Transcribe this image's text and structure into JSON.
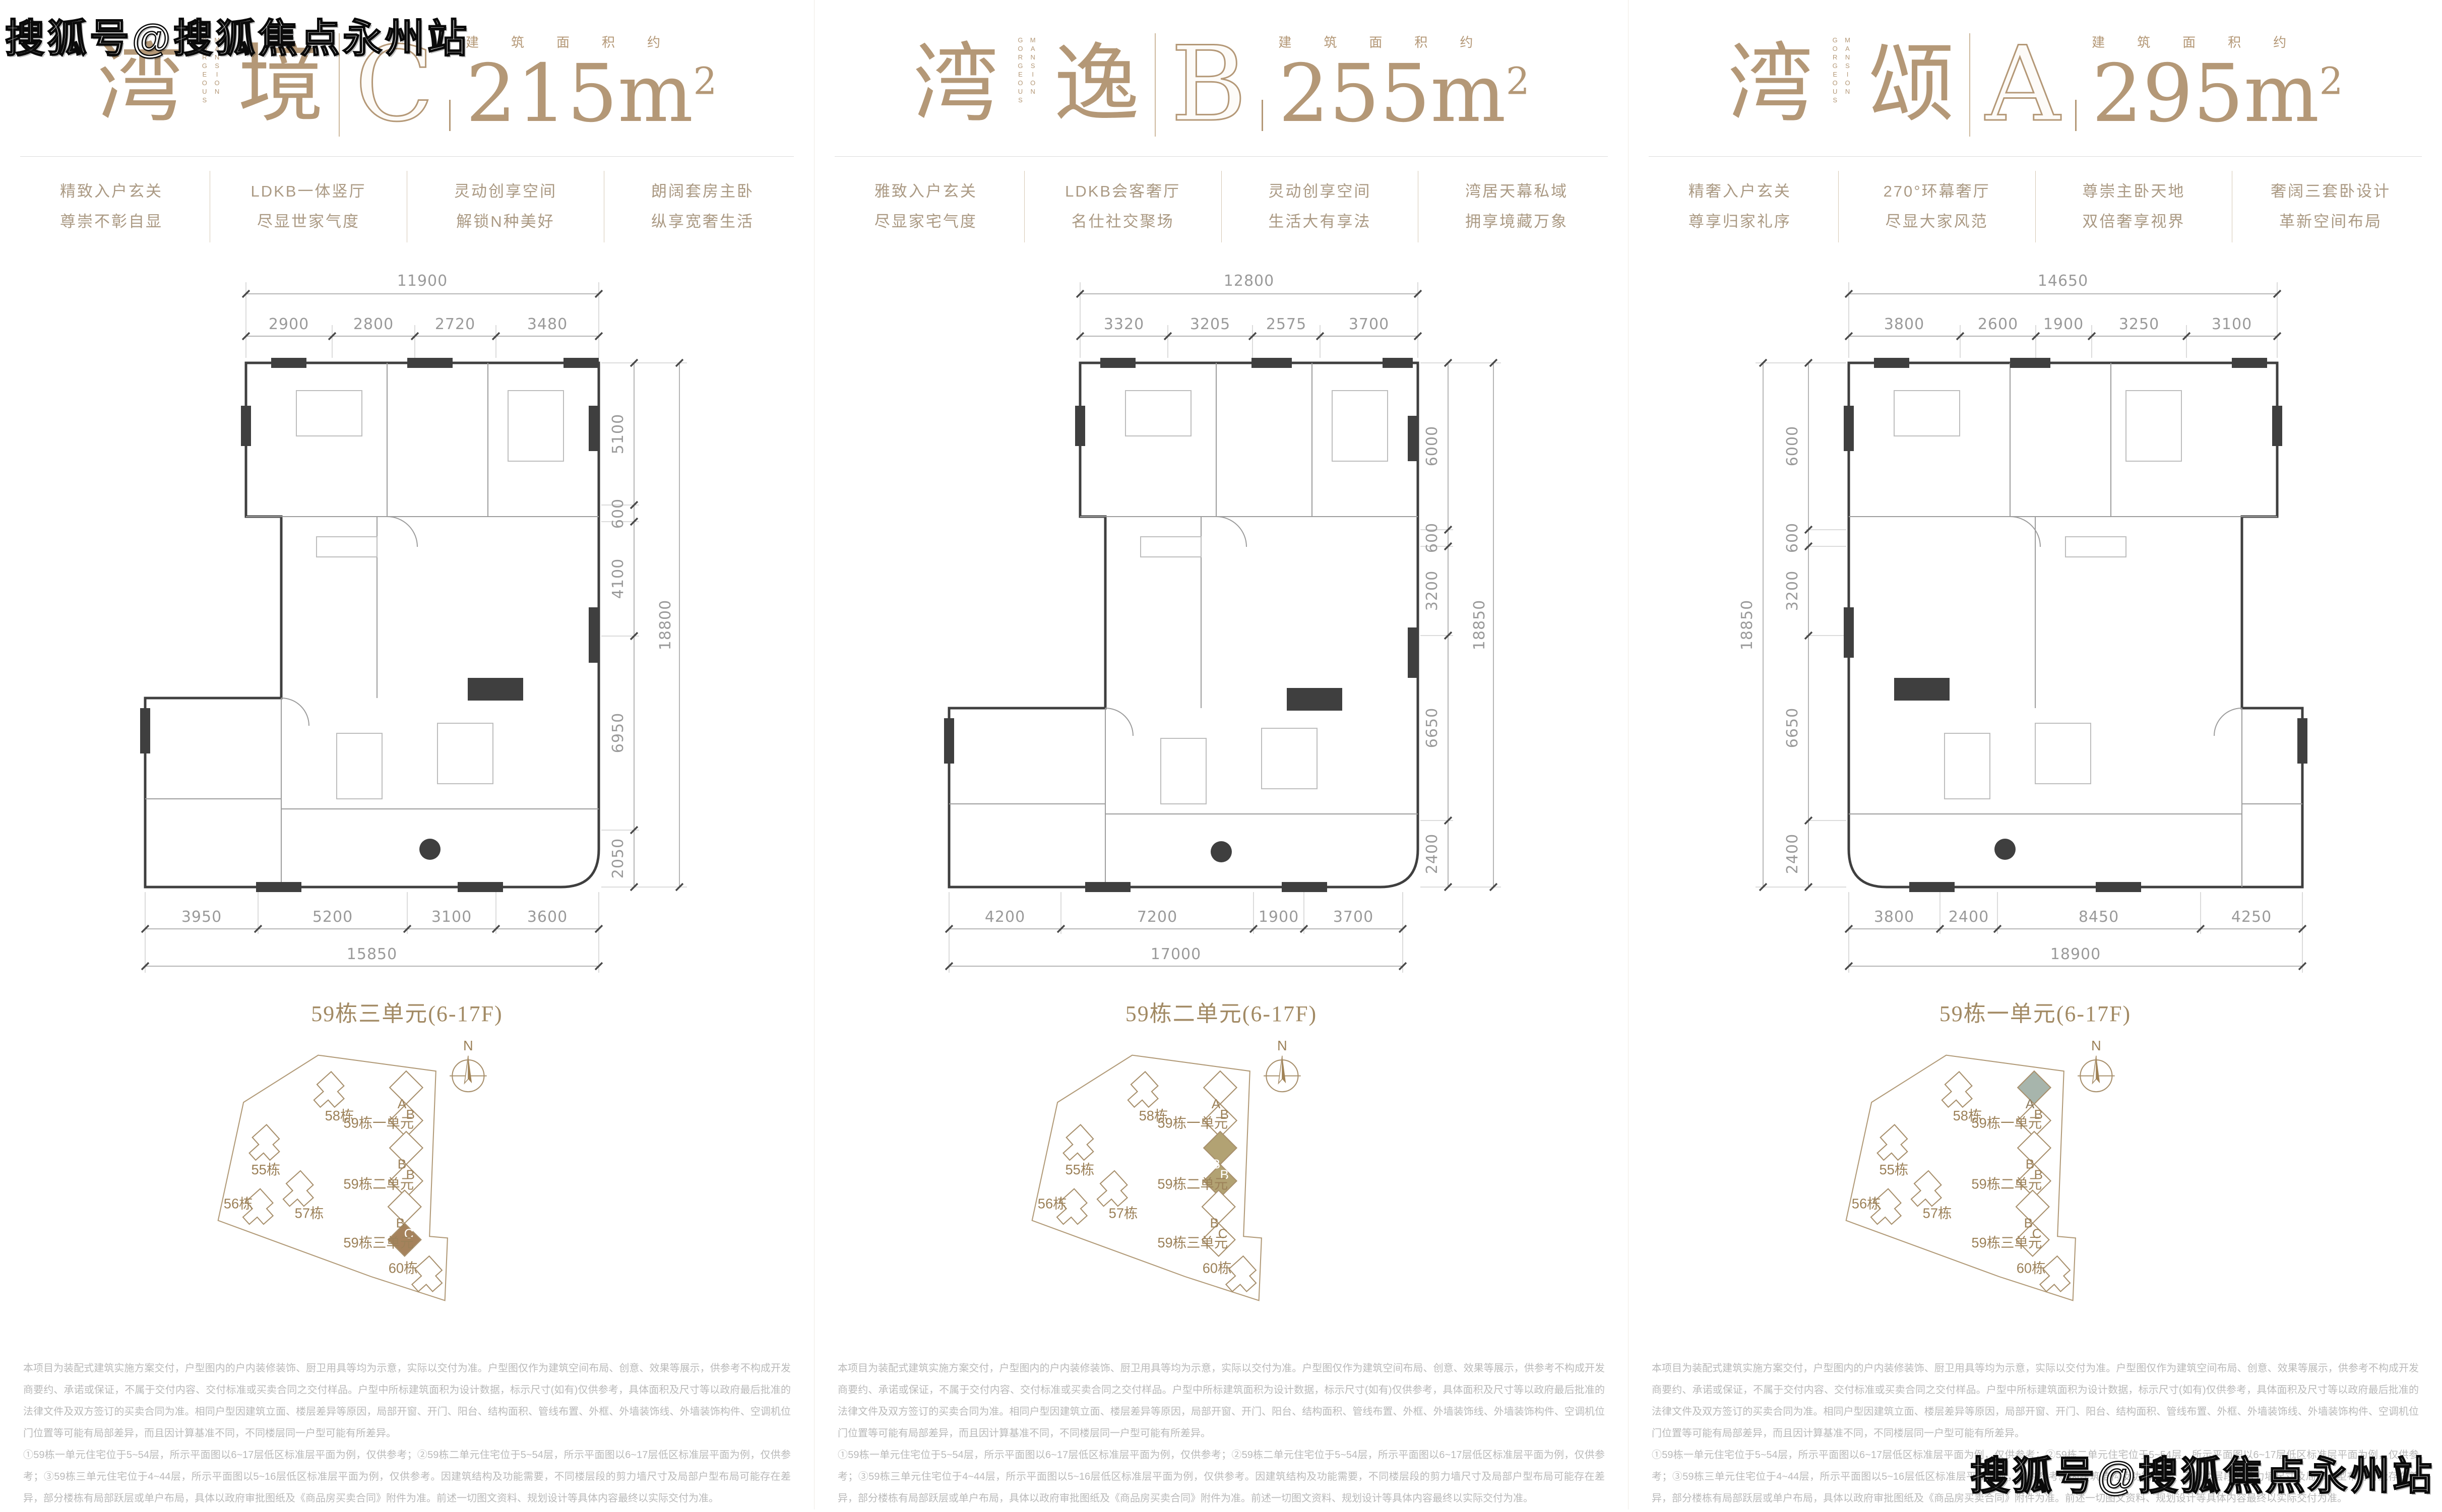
{
  "watermark": {
    "text": "搜狐号@搜狐焦点永州站"
  },
  "colors": {
    "title_tan": "#b49877",
    "feature_text": "#ab9a84",
    "unit_label_tan": "#a28a64",
    "dim_gray": "#9a9a9a",
    "wall_dark": "#3f3f3f",
    "site_line": "#a8906d",
    "site_text": "#9c8159",
    "highlight_unit_c": "#a5825c",
    "highlight_unit_b": "#b2a273",
    "highlight_unit_a": "#a7b5ac",
    "disclaimer_gray": "#b9b9b9"
  },
  "site": {
    "compass": "N",
    "labels": {
      "b55": "55栋",
      "b56": "56栋",
      "b57": "57栋",
      "b58": "58栋",
      "b60": "60栋",
      "u1": "59栋一单元",
      "u2": "59栋二单元",
      "u3": "59栋三单元"
    },
    "units": {
      "u1a": "A",
      "u1b": "B",
      "u2a": "B",
      "u2b": "B",
      "u3a": "B",
      "u3b": "C"
    }
  },
  "disclaimer": {
    "p1": "本项目为装配式建筑实施方案交付，户型图内的户内装修装饰、厨卫用具等均为示意，实际以交付为准。户型图仅作为建筑空间布局、创意、效果等展示，供参考不构成开发商要约、承诺或保证，不属于交付内容、交付标准或买卖合同之交付样品。户型中所标建筑面积为设计数据，标示尺寸(如有)仅供参考，具体面积及尺寸等以政府最后批准的法律文件及双方签订的买卖合同为准。相同户型因建筑立面、楼层差异等原因，局部开窗、开门、阳台、结构面积、管线布置、外框、外墙装饰线、外墙装饰构件、空调机位门位置等可能有局部差异，而且因计算基准不同，不同楼层同一户型可能有所差异。",
    "p2": "①59栋一单元住宅位于5~54层，所示平面图以6~17层低区标准层平面为例，仅供参考；②59栋二单元住宅位于5~54层，所示平面图以6~17层低区标准层平面为例，仅供参考；③59栋三单元住宅位于4~44层，所示平面图以5~16层低区标准层平面为例，仅供参考。因建筑结构及功能需要，不同楼层段的剪力墙尺寸及局部户型布局可能存在差异，部分楼栋有局部跃层或单户布局，具体以政府审批图纸及《商品房买卖合同》附件为准。前述一切图文资料、规划设计等具体内容最终以实际交付为准。"
  },
  "panels": [
    {
      "title": {
        "char1": "湾",
        "char2": "境",
        "en1": "GORGEOUS",
        "en2": "MANSION",
        "letter": "C",
        "area_label": "建筑面积约",
        "area_number": "215m",
        "area_exponent": "2"
      },
      "features": [
        [
          "精致入户玄关",
          "尊崇不彰自显"
        ],
        [
          "LDKB一体竖厅",
          "尽显世家气度"
        ],
        [
          "灵动创享空间",
          "解锁N种美好"
        ],
        [
          "朗阔套房主卧",
          "纵享宽奢生活"
        ]
      ],
      "plan": {
        "top_total": "11900",
        "top_dims": [
          "2900",
          "2800",
          "2720",
          "3480"
        ],
        "side_total": "18800",
        "side_dims": [
          "5100",
          "600",
          "4100",
          "6950",
          "2050"
        ],
        "bottom_dims": [
          "3950",
          "5200",
          "3100",
          "3600"
        ],
        "bottom_total": "15850"
      },
      "unit_label": "59栋三单元(6-17F)"
    },
    {
      "title": {
        "char1": "湾",
        "char2": "逸",
        "en1": "GORGEOUS",
        "en2": "MANSION",
        "letter": "B",
        "area_label": "建筑面积约",
        "area_number": "255m",
        "area_exponent": "2"
      },
      "features": [
        [
          "雅致入户玄关",
          "尽显家宅气度"
        ],
        [
          "LDKB会客奢厅",
          "名仕社交聚场"
        ],
        [
          "灵动创享空间",
          "生活大有享法"
        ],
        [
          "湾居天幕私域",
          "拥享境藏万象"
        ]
      ],
      "plan": {
        "top_total": "12800",
        "top_dims": [
          "3320",
          "3205",
          "2575",
          "3700"
        ],
        "side_total": "18850",
        "side_dims": [
          "6000",
          "600",
          "3200",
          "6650",
          "2400"
        ],
        "bottom_dims": [
          "4200",
          "7200",
          "1900",
          "3700"
        ],
        "bottom_total": "17000"
      },
      "unit_label": "59栋二单元(6-17F)"
    },
    {
      "title": {
        "char1": "湾",
        "char2": "颂",
        "en1": "GORGEOUS",
        "en2": "MANSION",
        "letter": "A",
        "area_label": "建筑面积约",
        "area_number": "295m",
        "area_exponent": "2"
      },
      "features": [
        [
          "精奢入户玄关",
          "尊享归家礼序"
        ],
        [
          "270°环幕奢厅",
          "尽显大家风范"
        ],
        [
          "尊崇主卧天地",
          "双倍奢享视界"
        ],
        [
          "奢阔三套卧设计",
          "革新空间布局"
        ]
      ],
      "plan": {
        "top_total": "14650",
        "top_dims": [
          "3800",
          "2600",
          "1900",
          "3250",
          "3100"
        ],
        "side_total": "18850",
        "side_dims": [
          "6000",
          "600",
          "3200",
          "6650",
          "2400"
        ],
        "bottom_dims": [
          "3800",
          "2400",
          "8450",
          "4250"
        ],
        "bottom_total": "18900"
      },
      "unit_label": "59栋一单元(6-17F)"
    }
  ]
}
